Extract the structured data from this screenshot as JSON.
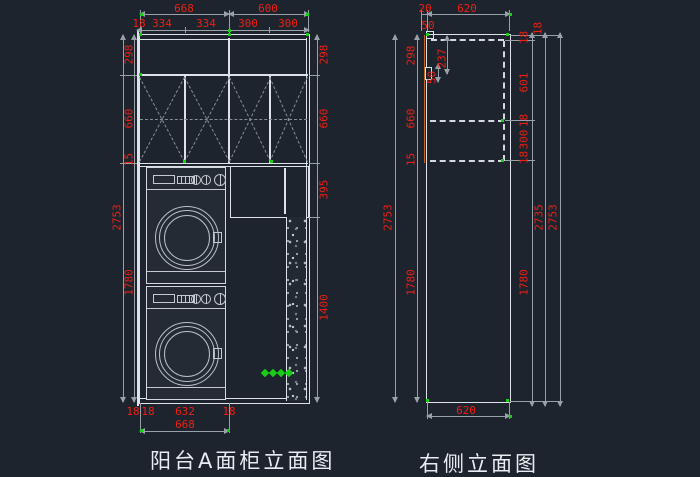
{
  "colors": {
    "background": "#1d242d",
    "line": "#dde2e8",
    "dim_text": "#ee1f13",
    "dim_line": "#98a0a8",
    "hidden_dash": "#868d95",
    "accent_orange": "#c2641f",
    "grip_green": "#17cf17"
  },
  "icons": {
    "green_diamond": "◆"
  },
  "left_view": {
    "title": "阳台A面柜立面图",
    "dims": {
      "top_row1": [
        "668",
        "600"
      ],
      "top_row2": [
        "18",
        "334",
        "334",
        "300",
        "300"
      ],
      "left_outer": "2753",
      "left_inner": [
        "298",
        "660",
        "15",
        "1780"
      ],
      "right": [
        "298",
        "660",
        "395",
        "1400"
      ],
      "bottom_row1": [
        "18",
        "18",
        "632",
        "18"
      ],
      "bottom_row2": "668"
    },
    "markers": {
      "green_diamonds": 4
    }
  },
  "right_view": {
    "title": "右侧立面图",
    "dims": {
      "top": [
        "20",
        "620"
      ],
      "top_50": "50",
      "handle": [
        "237",
        "50"
      ],
      "left_outer": "2753",
      "left_inner": [
        "298",
        "660",
        "15",
        "1780"
      ],
      "right_inner": [
        "18",
        "601",
        "18",
        "300",
        "18",
        "1780"
      ],
      "right_top18": "18",
      "right_mid": "2735",
      "right_outer": "2753",
      "bottom": "620"
    }
  }
}
